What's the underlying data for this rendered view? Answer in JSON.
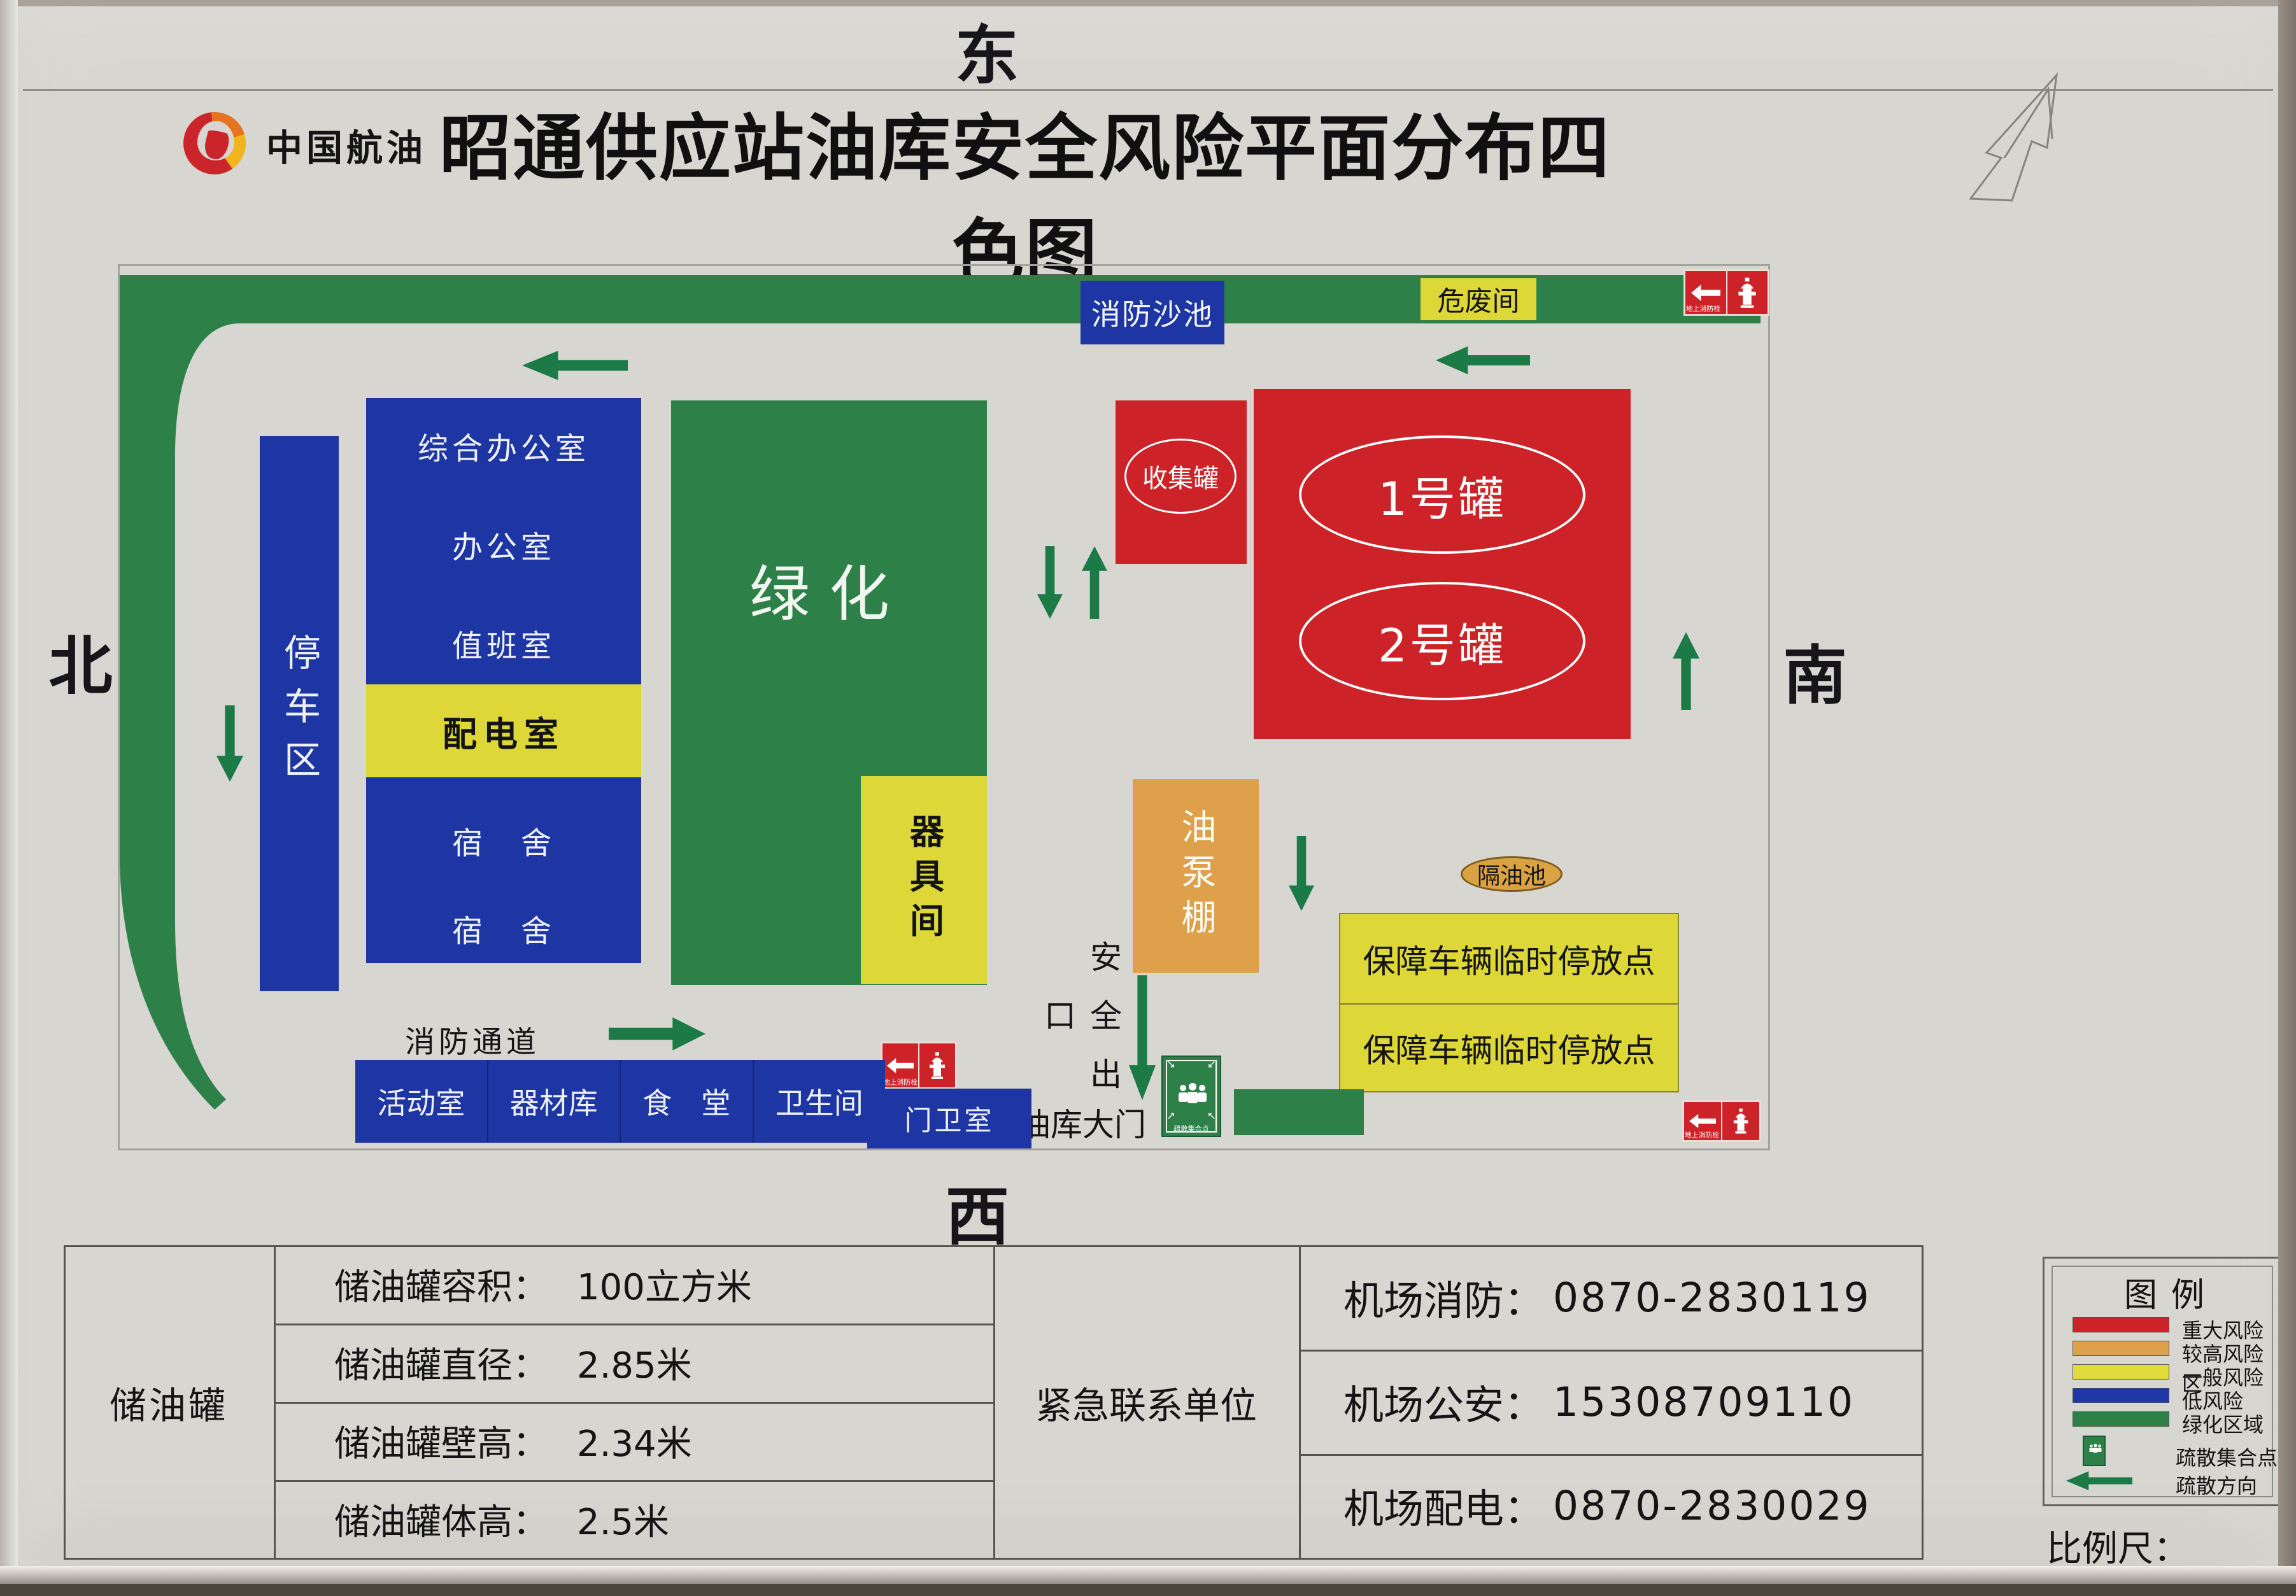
{
  "compass": {
    "east": "东",
    "south": "南",
    "west": "西",
    "north": "北"
  },
  "header": {
    "logo_text": "中国航油",
    "title": "昭通供应站油库安全风险平面分布四色图"
  },
  "map": {
    "fire_sand_pool": "消防沙池",
    "hazardous_waste_room": "危废间",
    "hydrant_label": "地上消防栓",
    "parking_area": "停车区",
    "office_rows": [
      "综合办公室",
      "办公室",
      "值班室",
      "配电室",
      "宿　舍",
      "宿　舍"
    ],
    "greenery": "绿化",
    "equipment_room": "器具间",
    "collection_tank": "收集罐",
    "tank_1": "1号罐",
    "tank_2": "2号罐",
    "oil_pump_shed": "油泵棚",
    "oil_separator": "隔油池",
    "support_parking_row1": "保障车辆临时停放点",
    "support_parking_row2": "保障车辆临时停放点",
    "safety_exit": "安全出口",
    "fire_lane": "消防通道",
    "bottom_rooms": [
      "活动室",
      "器材库",
      "食　堂",
      "卫生间"
    ],
    "guard_room": "门卫室",
    "depot_gate": "油库大门",
    "assembly_label": "疏散集合点"
  },
  "info_table": {
    "tank_header": "储油罐",
    "specs": [
      {
        "label": "储油罐容积：",
        "value": "100立方米"
      },
      {
        "label": "储油罐直径：",
        "value": "2.85米"
      },
      {
        "label": "储油罐壁高：",
        "value": "2.34米"
      },
      {
        "label": "储油罐体高：",
        "value": "2.5米"
      }
    ],
    "emergency_header": "紧急联系单位",
    "contacts": [
      {
        "label": "机场消防：",
        "value": "0870-2830119"
      },
      {
        "label": "机场公安：",
        "value": "15308709110"
      },
      {
        "label": "机场配电：",
        "value": "0870-2830029"
      }
    ]
  },
  "legend": {
    "title": "图例",
    "items": [
      {
        "label": "重大风险",
        "color": "#cd2328"
      },
      {
        "label": "较高风险区",
        "color": "#dfa04b"
      },
      {
        "label": "一般风险",
        "color": "#e0da3a"
      },
      {
        "label": "低风险",
        "color": "#2038a6"
      },
      {
        "label": "绿化区域",
        "color": "#2e8049"
      }
    ],
    "assembly_point": "疏散集合点",
    "evacuation_direction": "疏散方向",
    "scale_label": "比例尺："
  },
  "colors": {
    "major_risk": "#cd2328",
    "higher_risk": "#dfa04b",
    "general_risk": "#e0da3a",
    "low_risk": "#2038a6",
    "green_area": "#2e8049",
    "arrow_green": "#1b7a45",
    "poster_bg": "#d7d6d1"
  }
}
